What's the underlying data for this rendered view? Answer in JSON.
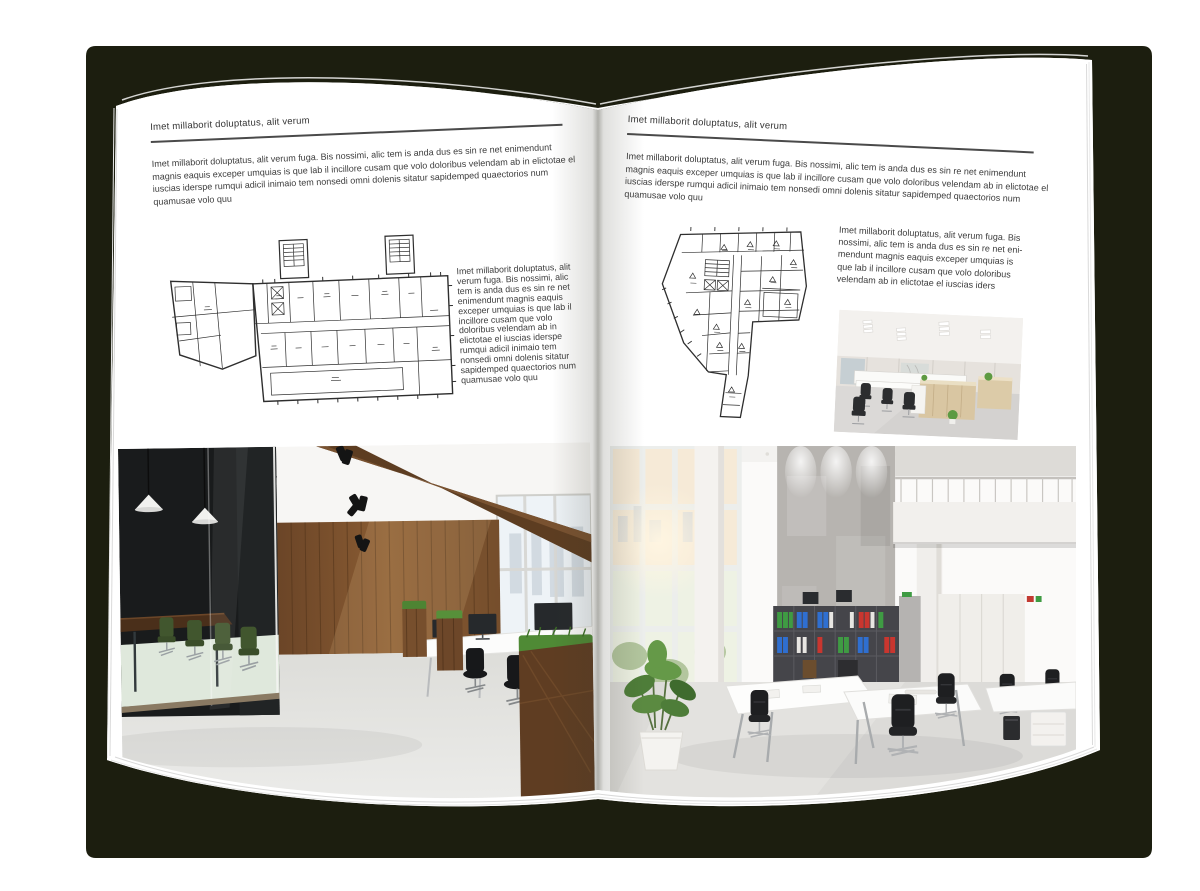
{
  "book": {
    "cover_color": "#1c1e0f",
    "page_color": "#ffffff",
    "text_color": "#3c3c3c"
  },
  "left_page": {
    "header": "Imet millaborit doluptatus, alit verum",
    "intro": "Imet millaborit doluptatus, alit verum fuga. Bis nossimi, alic tem is anda dus es sin re net enimendunt magnis eaquis exceper umquias is que lab il incillore cusam que volo doloribus velendam ab in elictotae el iuscias iderspe rumqui adicil inimaio tem nonsedi omni dolenis sitatur sapidemped quaectorios num quamusae volo quu",
    "caption": "Imet millaborit doluptatus, alit verum fuga. Bis nossimi, alic tem is anda dus es sin re net enimendunt magnis eaquis exceper umquias is que lab il incillore cusam que volo doloribus velendam ab in elictotae el iuscias iderspe rumqui adicil inimaio tem nonsedi omni dolenis sitatur sapidemped quaectorios num quamusae volo quu",
    "floorplan": "wide-office-building-floor-plan",
    "photo": "dark-loft-office-interior"
  },
  "right_page": {
    "header": "Imet millaborit doluptatus, alit verum",
    "intro": "Imet millaborit doluptatus, alit verum fuga. Bis nossimi, alic tem is anda dus es sin re net enimendunt magnis eaquis exceper umquias is que lab il incillore cusam que volo doloribus velendam ab in elictotae el iuscias iderspe rumqui adicil inimaio tem nonsedi omni dolenis sitatur sapidemped quaectorios num quamusae volo quu",
    "caption": "Imet millaborit doluptatus, alit verum fuga. Bis nossimi, alic tem is anda dus es sin re net eni-mendunt magnis eaquis exceper umquias is que lab il incillore cusam que volo doloribus velendam ab in elictotae el iuscias iders",
    "floorplan": "irregular-office-building-floor-plan",
    "photo_small": "open-plan-office-interior",
    "photo": "bright-atrium-office-interior"
  }
}
